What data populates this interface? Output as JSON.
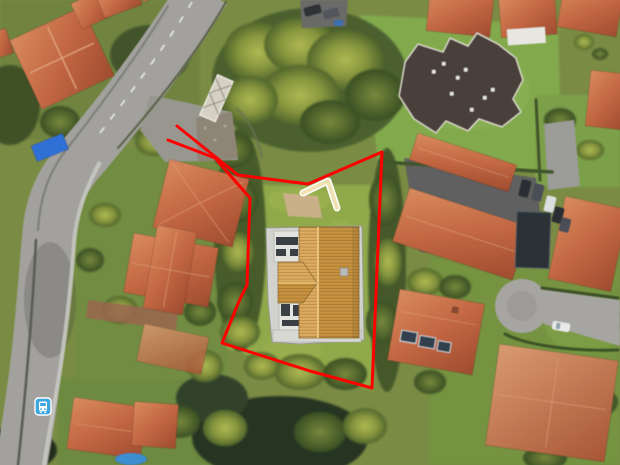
{
  "map": {
    "view": {
      "width_px": 620,
      "height_px": 465,
      "imagery": "satellite-aerial"
    },
    "annotations": {
      "property_boundary": {
        "color": "#FF0000",
        "stroke_width": 3,
        "points": "177,126 238,175 308,184 382,152 377,270 372,388 310,371 222,343 240,299 247,285 250,198 215,158 168,140"
      },
      "access_path": {
        "fill_color": "#EFE1B2",
        "casing_color": "#FFFFFF",
        "points": "303,193 328,181 337,208"
      },
      "proposed_building": {
        "roof_color": "#C6923F",
        "roof_color_light": "#DCAB60",
        "ridge_color": "#E8C27C",
        "wall_color": "#E3E3E0",
        "terrace_color": "#D2D2CF"
      }
    },
    "markers": [
      {
        "name": "transit-stop",
        "type": "bus",
        "color": "#3DA5E0",
        "transform": "translate(35,398)"
      }
    ]
  }
}
